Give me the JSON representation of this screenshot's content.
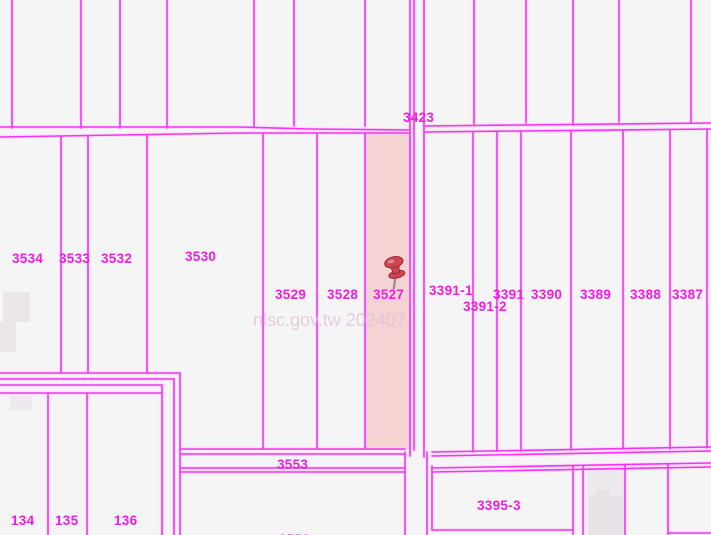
{
  "map": {
    "selected_parcel": "3527",
    "watermark": "nlsc.gov.tw 202407",
    "colors": {
      "background": "#f6f5f5",
      "line": "#f32cf3",
      "line_glow": "#fbc9fb",
      "label": "#ee1ce6",
      "highlight": "#f5d3d3",
      "watermark": "#dfc0d8",
      "building": "#e6e2e6",
      "building_light": "#edeaed",
      "pin_body": "#ce4553",
      "pin_dark": "#9e2734",
      "pin_light": "#e8929b",
      "pin_needle": "#8f8f8f"
    },
    "labels": {
      "p3423": "3423",
      "p3534": "3534",
      "p3533": "3533",
      "p3532": "3532",
      "p3530": "3530",
      "p3529": "3529",
      "p3528": "3528",
      "p3527": "3527",
      "p3391_1": "3391-1",
      "p3391_2": "3391-2",
      "p3391": "3391",
      "p3390": "3390",
      "p3389": "3389",
      "p3388": "3388",
      "p3387": "3387",
      "p3553": "3553",
      "p3395_3": "3395-3",
      "p134": "134",
      "p135": "135",
      "p136": "136",
      "p3552_partial": "3552"
    }
  }
}
